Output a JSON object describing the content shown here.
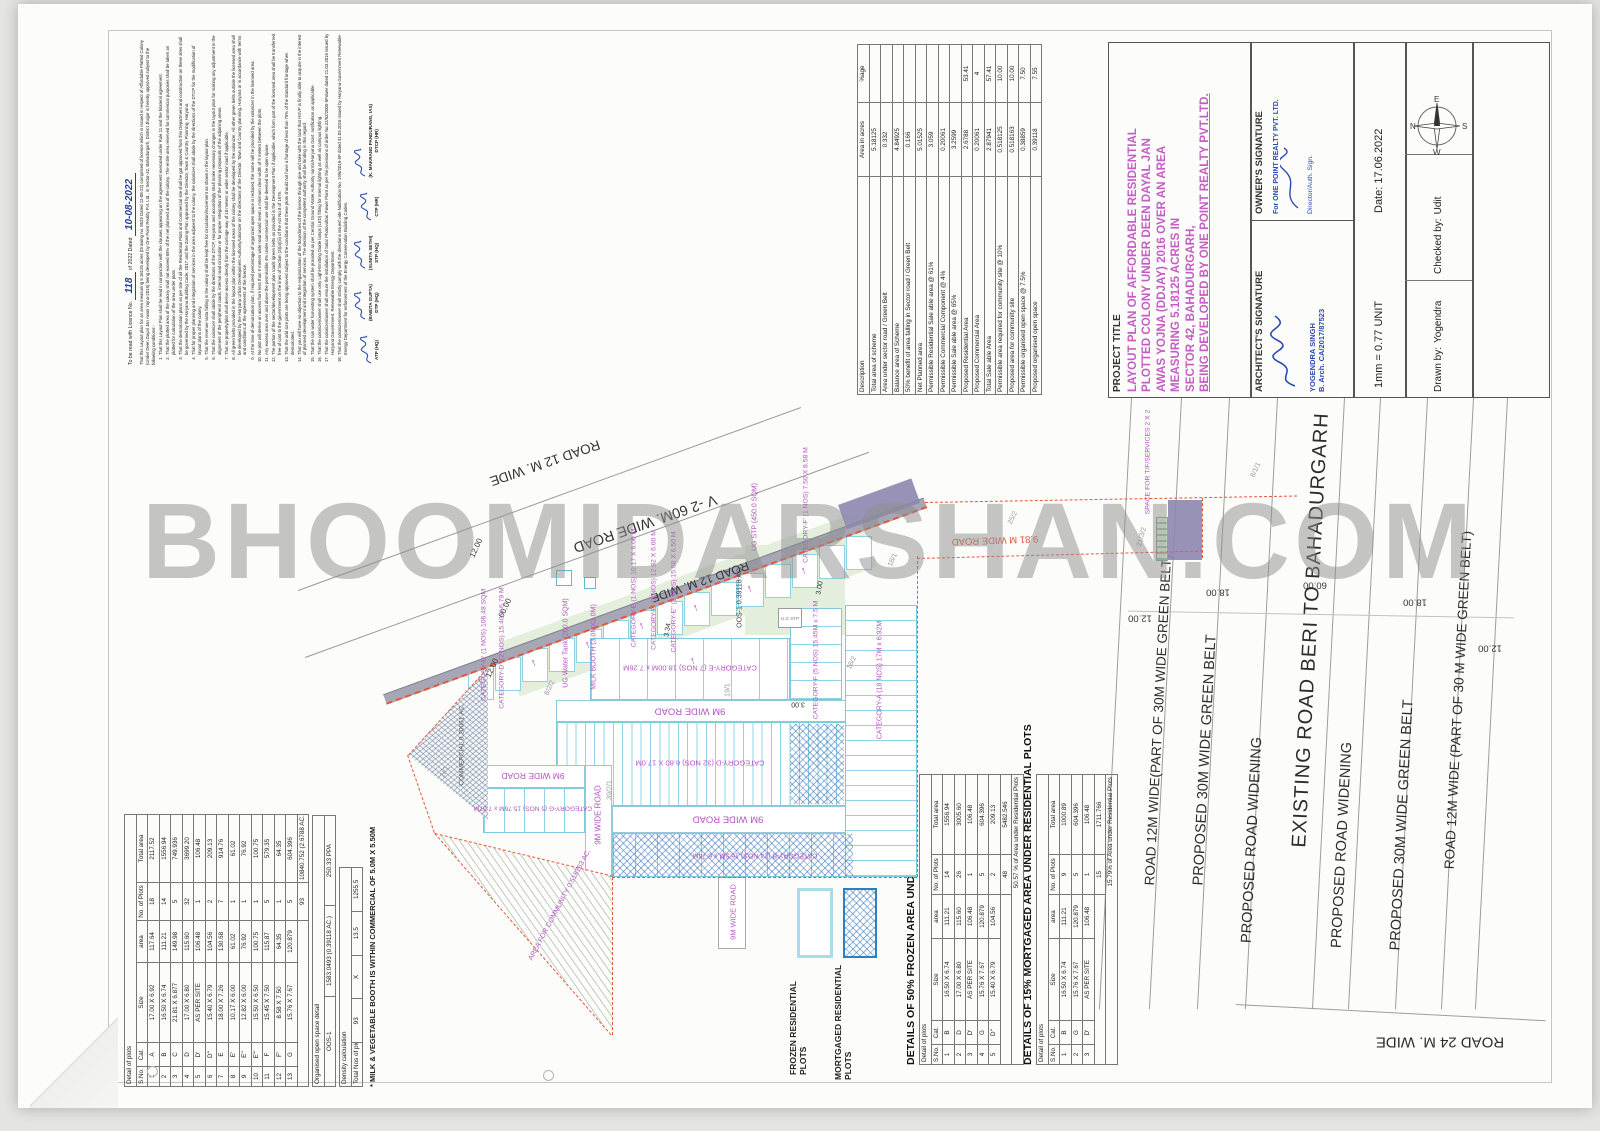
{
  "watermark": "BHOOMIDARSHAN.COM",
  "license_note": {
    "prefix": "To be read with Licence No.",
    "license_no": "118",
    "mid": "of 2022 Dated",
    "license_date": "10-08-2022",
    "intro": "That this Layout plan for an area measuring 5.18125 acres (Drawing no. 8529 Dated 12-08-22) comprised of licence which is issued in respect of Affordable Plotted Colony (Under Deen Dayal Jan Awas Yojna-2016) being developed by One Point Reality Pvt. Ltd., in Sector-42, Bahadurgarh, District Jhajjar is hereby approved subject to the following conditions:-",
    "conditions": [
      "That this Layout Plan shall be read in conjunction with the clauses appearing on the agreement executed under Rule 11 and the bilateral agreement.",
      "That the plotted area of the colony shall not exceed 65% of the net planned area of the colony. The entire area reserved for commercial purposes shall be taken an plotted for calculation of the area under plots.",
      "That the demarcation plans as per site of all the Residential Plots and Commercial site shall be got approved from this Department and construction on these sites shall be governed by the Haryana Building Code, 2017 and the Zoning Plan approved by the Director, Town & Country Planning, Haryana.",
      "That for proper planning and integration of services in the area adjacent to the colony, the colonizer shall abide by the directions of the DTCP for the modification of layout plans of the colony.",
      "That the revenue rasta falling in the colony shall be kept free for circulation/movement as shown in the layout plan.",
      "That the colonizer shall abide by the directions of the DTCP, Haryana and accordingly shall make necessary changes in the layout plan for making any adjustment in the alignment of the peripheral roads, internal road circulation or for proper integration of the planning proposals of the adjoining areas.",
      "That no property/plot shall derive access directly from the carriage way of 10 meters or wider sector road if applicable.",
      "All green belts provided in the layout plan within the licensed areas of the colony shall be developed by the colonizer. All other green belts outside the licensed area shall be developed by the Haryana Urban Development Authority/colonizer on the directions of the Director, Town and Country planning, Haryana or in accordance with terms and conditions of the agreements of the licence.",
      "At the time of demarcation plan, if required percentage of organized open space is reduced, the same will be provided by the colonizer in the licensed area.",
      "No plot will derive an access from less than 9 meters wide road would mean a minimum clear width of 9 meters between the plots.",
      "Any excess area over and above the permissible 4% under commercial use shall be deemed to be open space.",
      "The portion of the sector/development plan roads /green belts as provided in the Development Plan if applicable, which form part of the licensed area shall be transferred free of cost to the government on the lines of Section (3)(a)(iii) of the Act No.8 of 1975.",
      "That the odd size plots are being approved subject to the conditions that these plots should not have a frontage of less than 75% of the standard frontage when demarcated.",
      "That you will have no objection to the regularization of the boundaries of the licence through give and take with the land that HSVP is finally able to acquire in the interest of planned development and integration of services. The decision of the competent authority shall be binding in this regard.",
      "That the rain water harvesting system shall be provided as per Central Ground Water Authority norms/Haryana Govt. notification as applicable.",
      "That the colonizer/owner shall use only Light-Emitting Diode lamps (LED) fitting for internal lighting as well as campus lighting.",
      "That the colonizer/owner shall ensure the installation of Solar Photovoltaic Power Plant as per the provisions of order No.22/52/2005-5Power dated 21.03.2016 issued by Haryana Government, Renewable Energy Department.",
      "That the colonizer/owner shall strictly comply with the directions issued vide Notification No. 19/6/2016-5P dated 31.03.2016 issued by Haryana Government Renewable Energy Department for enforcement of the Energy Conservation Building Codes."
    ],
    "stamps": [
      {
        "name": "",
        "title": "ATP (HQ)"
      },
      {
        "name": "(BABITA GUPTA)",
        "title": "DTP (HQ)"
      },
      {
        "name": "(SUNITA SETHI)",
        "title": "STP (HQ)"
      },
      {
        "name": "",
        "title": "CTP (HR)"
      },
      {
        "name": "(K. MAKRAND PANDURANG, IAS)",
        "title": "DTCP (HR)"
      }
    ]
  },
  "area_statement": {
    "headers": [
      "Description",
      "Area in acres",
      "%age"
    ],
    "rows": [
      [
        "Total area of scheme",
        "5.18125",
        ""
      ],
      [
        "Area under sector road / Green Belt",
        "0.332",
        ""
      ],
      [
        "Balance area of Scheme",
        "4.84925",
        ""
      ],
      [
        "50% benefit of area falling in Sector road / Green Belt",
        "0.166",
        ""
      ],
      [
        "Net Planned area",
        "5.01525",
        ""
      ],
      [
        "Permissible Residential Sale able area @ 61%",
        "3.059",
        ""
      ],
      [
        "Permissible Commercial Component @ 4%",
        "0.20061",
        ""
      ],
      [
        "Permissible Sale able area @ 65%",
        "3.2599",
        ""
      ],
      [
        "Proposed Residential Area",
        "2.6788",
        "53.41"
      ],
      [
        "Proposed Commercial Area",
        "0.20061",
        "4"
      ],
      [
        "Total Sale able Area",
        "2.87941",
        "57.41"
      ],
      [
        "Permissible area required for community site @ 10%",
        "0.518125",
        "10.00"
      ],
      [
        "Proposed area for community site",
        "0.518163",
        "10.00"
      ],
      [
        "Permissible organised open space @ 7.5%",
        "0.38859",
        "7.50"
      ],
      [
        "Proposed organised open space",
        "0.39118",
        "7.55"
      ]
    ]
  },
  "title_block": {
    "project_title_label": "PROJECT TITLE",
    "project_title_lines": [
      "LAYOUT PLAN OF AFFORDABLE RESIDENTIAL",
      "PLOTTED COLONY UNDER DEEN DAYAL JAN",
      "AWAS YOJNA (DDJAY) 2016 OVER AN AREA",
      "MEASURING 5.18125 ACRES IN",
      "SECTOR 42, BAHADURGARH,",
      "BEING DEVELOPED BY ONE POINT REALTY PVT.LTD."
    ],
    "architect_label": "ARCHITECT'S SIGNATURE",
    "architect_name": "YOGENDRA SINGH",
    "architect_qual": "B. Arch.",
    "architect_reg": "CA/2017/87523",
    "owner_label": "OWNER'S SIGNATURE",
    "owner_for": "For ONE POINT REALTY PVT. LTD.",
    "owner_auth": "Director/Auth. Sign.",
    "scale": "1mm = 0.77 UNIT",
    "date_label": "Date:",
    "date_value": "17.06.2022",
    "drawn_label": "Drawn by:",
    "drawn_value": "Yogendra",
    "checked_label": "Checked by:",
    "checked_value": "Udit",
    "compass": {
      "n": "N",
      "e": "E",
      "s": "S",
      "w": "W"
    }
  },
  "plot_table": {
    "title": "Detail of plots",
    "headers": {
      "sn": "S.No.",
      "cat": "Cat.",
      "size": "Size",
      "area": "area",
      "nos": "No. of Plots",
      "total": "Total area"
    },
    "rows": [
      [
        "1",
        "A",
        "17.00 X 6.92",
        "117.64",
        "18",
        "2117.52"
      ],
      [
        "2",
        "B",
        "16.50 X 6.74",
        "111.21",
        "14",
        "1556.94"
      ],
      [
        "3",
        "C",
        "21.81 X 6.877",
        "149.98",
        "5",
        "749.936"
      ],
      [
        "4",
        "D",
        "17.00 X 6.80",
        "115.60",
        "32",
        "3699.20"
      ],
      [
        "5",
        "D'",
        "AS PER SITE",
        "106.48",
        "1",
        "106.48"
      ],
      [
        "6",
        "D''",
        "15.40 X 6.79",
        "104.56",
        "2",
        "209.13"
      ],
      [
        "7",
        "E",
        "18.00 X 7.26",
        "130.68",
        "7",
        "914.76"
      ],
      [
        "8",
        "E'",
        "10.17 X 6.00",
        "61.02",
        "1",
        "61.02"
      ],
      [
        "9",
        "E''",
        "12.82 X 6.00",
        "76.92",
        "1",
        "76.92"
      ],
      [
        "10",
        "E'''",
        "15.50 X 6.50",
        "100.75",
        "1",
        "100.75"
      ],
      [
        "11",
        "F",
        "15.45 X 7.50",
        "115.87",
        "5",
        "579.35"
      ],
      [
        "12",
        "F'",
        "8.58 X 7.50",
        "64.35",
        "1",
        "64.35"
      ],
      [
        "13",
        "G",
        "15.76 X 7.67",
        "120.879",
        "5",
        "604.396"
      ]
    ],
    "total_label": "Total Nos of plots",
    "total_nos": "93",
    "total_area": "10840.752 (2.6788 AC.)",
    "oos_title": "Organised open space detail",
    "oos_row": [
      "OOS-1",
      "1583.0493 (0.39118 AC.)",
      "250.33 PPA"
    ],
    "density_title": "Density calculation",
    "density_row": [
      "Total Nos of plots",
      "93",
      "X",
      "13.5",
      "1255.5"
    ],
    "note": "* MILK & VEGETABLE BOOTH IS WITHIN COMMERCIAL OF 5.0M X 5.50M"
  },
  "frozen_table": {
    "title": "DETAILS OF 50% FROZEN  AREA UNDER  RESIDENTIAL  PLOTS",
    "subtitle": "Detail of plots",
    "rows": [
      [
        "1",
        "B",
        "16.50 X 6.74",
        "111.21",
        "14",
        "1556.94"
      ],
      [
        "2",
        "D",
        "17.00 X 6.80",
        "115.60",
        "26",
        "3005.60"
      ],
      [
        "3",
        "D'",
        "AS PER SITE",
        "106.48",
        "1",
        "106.48"
      ],
      [
        "4",
        "G",
        "15.76 X 7.67",
        "120.879",
        "5",
        "604.396"
      ],
      [
        "5",
        "D''",
        "15.40 X 6.79",
        "104.56",
        "2",
        "209.13"
      ]
    ],
    "total_nos": "48",
    "total_area": "5482.546",
    "pct": "50.57 % of Area under Residential Plots"
  },
  "mortgaged_table": {
    "title": "DETAILS OF 15%  MORTGAGED  AREA UNDER  RESIDENTIAL  PLOTS",
    "subtitle": "Detail of plots",
    "rows": [
      [
        "1",
        "B",
        "16.50 X 6.74",
        "111.21",
        "9",
        "1000.89"
      ],
      [
        "2",
        "G",
        "15.76 X 7.67",
        "120.879",
        "5",
        "604.396"
      ],
      [
        "3",
        "D'",
        "AS PER SITE",
        "106.48",
        "1",
        "106.48"
      ]
    ],
    "total_nos": "15",
    "total_area": "1711.766",
    "pct": "15.79% of Area under Residential Plots"
  },
  "legend": {
    "frozen": "FROZEN RESIDENTIAL PLOTS",
    "mortgaged": "MORTGAGED RESIDENTIAL PLOTS"
  },
  "plan": {
    "roads": {
      "r12_top": "ROAD 12 M. WIDE",
      "v2_60": "V -2 60M. WIDE ROAD",
      "r12_mid": "ROAD 12 M. WIDE",
      "w9": "9M WIDE ROAD",
      "w981": "9.81 M WIDE ROAD"
    },
    "cats": {
      "c_d1": "CATEGORY-D' (1 NOS) 106.48 SQM",
      "c_d2": "CATEGORY-D'' (2 NOS) 15.40 X 6.79 M",
      "c_e1": "CATEGORY-E (1 NOS) 10.17 X 6.00 M",
      "c_e1p": "CATEGORY-E' (1 NOS) 12.82 X 6.00 M",
      "c_e2p": "CATEGORY-E'' (1 NOS) 15.50 X 6.50 M",
      "c_e7": "CATEGORY-E (7 NOS) 18.00M x 7.26M",
      "c_d32": "CATEGORY-D (32 NOS) 6.80 X 17.0M",
      "c_b14": "CATEGORY-B (14 NOS) 16.5M x 6.74M",
      "c_g5": "CATEGORY-G (5 NOS) 15.76M x 7.67M",
      "c_f5": "CATEGORY-F (5 NOS) 15.45M x 7.5 M",
      "c_f1": "CATEGORY-F' (1 NOS) 7.50 X 8.58 M",
      "c_a18": "CATEGORY-A (18 NOS) 17M x 6.92M"
    },
    "util": {
      "ug_water": "UG Water Tank (200.0 SQM)",
      "milk": "MILK BOOTH (3.0MX3.0M)",
      "ug_stp": "UG STP (450.0 SQM)",
      "ug_stp_small": "U.G STP",
      "space_tf": "SPACE FOR T/F/SERVICES 2 X 2"
    },
    "areas": {
      "commercial": "COMMERCIAL 0.20061 AC.",
      "community": "AREA FOR COMMUNITY 0.518163 AC.",
      "oos": "OOS-1  0.39118 AC."
    },
    "khasra": {
      "k1": "8/2/2",
      "k2": "19/1",
      "k3": "18/1",
      "k4": "18/2",
      "k5": "25/2",
      "k6": "39/2/1",
      "k7": "2//1",
      "k8": "8/1/1",
      "k9": "21/3/2"
    },
    "dims": {
      "d1": "12.00",
      "d2": "60.00",
      "d3": "12.00",
      "d4": "3.34",
      "d5": "3.00",
      "d6": "3.00",
      "r1": "12.00",
      "r2": "18.00",
      "r3": "60.00",
      "r4": "18.00",
      "r5": "12.00"
    },
    "arrow_glyph": "↑"
  },
  "strips": {
    "s1": "ROAD 12M WIDE(PART OF 30M WIDE GREEN BELT)",
    "s2": "PROPOSED 30M WIDE  GREEN BELT",
    "s3": "PROPOSED ROAD  WIDENING",
    "s4": "EXISTING ROAD BERI TO BAHADURGARH",
    "s6": "ROAD 12M WIDE (PART OF 30 M WIDE GREEN BELT)",
    "s7": "ROAD 24 M. WIDE"
  }
}
